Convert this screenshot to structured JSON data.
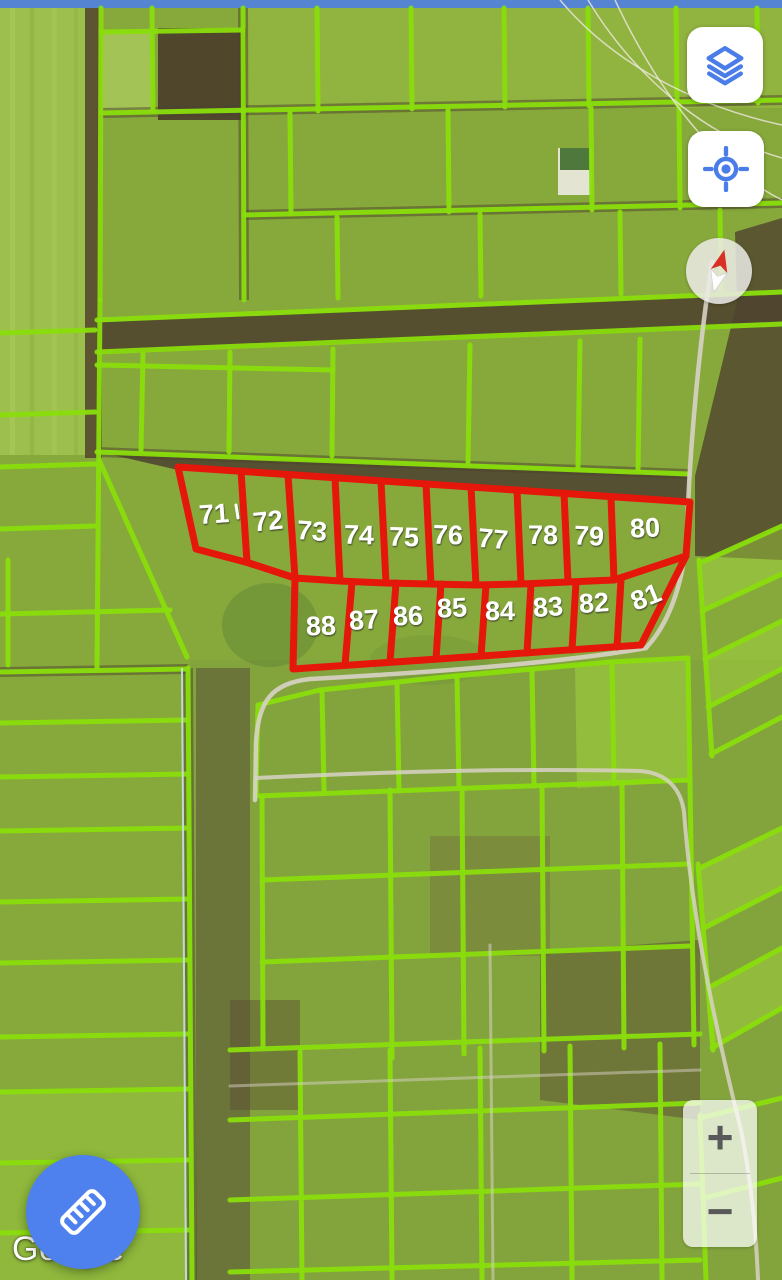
{
  "attribution": {
    "logo_text": "Google"
  },
  "controls": {
    "layers_button": {
      "icon": "layers-icon"
    },
    "my_location_button": {
      "icon": "my-location-icon"
    },
    "compass": {
      "icon": "compass-needle-icon",
      "needle_rotation_deg": 14
    },
    "zoom_in_label": "+",
    "zoom_out_label": "−",
    "measure_button": {
      "icon": "ruler-icon"
    }
  },
  "colors": {
    "control_icon_blue": "#4A7DE8",
    "fab_blue": "#4E80EE",
    "parcel_line_green": "#8ADE0C",
    "selected_parcel_red": "#E5170B",
    "parcel_label_white": "#FFFFFF",
    "field_green": "#87A93C",
    "soil_brown": "#4D4130",
    "top_strip_blue": "#5585D2",
    "road_gray": "#D8D2C6"
  },
  "red_parcels": {
    "row_top_numbers": [
      "71",
      "72",
      "73",
      "74",
      "75",
      "76",
      "77",
      "78",
      "79",
      "80"
    ],
    "row_bottom_numbers": [
      "88",
      "87",
      "86",
      "85",
      "84",
      "83",
      "82",
      "81"
    ],
    "outer": "178,467 690,502 686,556 641,645 293,669 295,578 249,563 196,549",
    "middle_line": "249,563 295,578 340,581 386,583 431,584 476,585 521,584 568,582 614,580 686,556",
    "dividers": [
      [
        241,
        471,
        247,
        562
      ],
      [
        288,
        475,
        295,
        578
      ],
      [
        335,
        478,
        340,
        581
      ],
      [
        381,
        481,
        386,
        583
      ],
      [
        426,
        484,
        431,
        584
      ],
      [
        471,
        487,
        476,
        585
      ],
      [
        517,
        490,
        521,
        584
      ],
      [
        564,
        493,
        568,
        582
      ],
      [
        611,
        497,
        614,
        580
      ],
      [
        352,
        582,
        345,
        665
      ],
      [
        396,
        583,
        390,
        662
      ],
      [
        441,
        584,
        436,
        659
      ],
      [
        486,
        585,
        481,
        656
      ],
      [
        531,
        584,
        527,
        653
      ],
      [
        576,
        582,
        572,
        650
      ],
      [
        621,
        580,
        617,
        647
      ]
    ],
    "labels": [
      {
        "n": "71",
        "x": 214,
        "y": 514,
        "r": -4
      },
      {
        "n": "72",
        "x": 268,
        "y": 521,
        "r": -6
      },
      {
        "n": "73",
        "x": 312,
        "y": 531,
        "r": 4
      },
      {
        "n": "74",
        "x": 359,
        "y": 535,
        "r": 2
      },
      {
        "n": "75",
        "x": 404,
        "y": 537,
        "r": 2
      },
      {
        "n": "76",
        "x": 448,
        "y": 535,
        "r": 2
      },
      {
        "n": "77",
        "x": 493,
        "y": 539,
        "r": 5
      },
      {
        "n": "78",
        "x": 543,
        "y": 535,
        "r": 0
      },
      {
        "n": "79",
        "x": 589,
        "y": 536,
        "r": 3
      },
      {
        "n": "80",
        "x": 645,
        "y": 528,
        "r": -3
      },
      {
        "n": "81",
        "x": 646,
        "y": 597,
        "r": -22
      },
      {
        "n": "82",
        "x": 594,
        "y": 603,
        "r": -4
      },
      {
        "n": "83",
        "x": 548,
        "y": 607,
        "r": -4
      },
      {
        "n": "84",
        "x": 500,
        "y": 611,
        "r": 0
      },
      {
        "n": "85",
        "x": 452,
        "y": 608,
        "r": -3
      },
      {
        "n": "86",
        "x": 408,
        "y": 616,
        "r": -2
      },
      {
        "n": "87",
        "x": 364,
        "y": 620,
        "r": -4
      },
      {
        "n": "88",
        "x": 321,
        "y": 626,
        "r": -2
      }
    ],
    "tick_mark": [
      236,
      505,
      238,
      518
    ]
  },
  "map_geometry": {
    "patches": [
      {
        "r": [
          0,
          8,
          97,
          447
        ],
        "f": "#9CBF4D",
        "o": 1
      },
      {
        "r": [
          10,
          8,
          5,
          447
        ],
        "f": "#AECD61",
        "o": 0.5
      },
      {
        "r": [
          30,
          8,
          4,
          447
        ],
        "f": "#8FB23F",
        "o": 0.6
      },
      {
        "r": [
          52,
          8,
          5,
          447
        ],
        "f": "#AECD61",
        "o": 0.4
      },
      {
        "r": [
          74,
          8,
          4,
          447
        ],
        "f": "#93B542",
        "o": 0.6
      },
      {
        "r": [
          85,
          8,
          17,
          450
        ],
        "f": "#57492F",
        "o": 0.9
      },
      {
        "r": [
          244,
          8,
          538,
          100
        ],
        "f": "#97BA41",
        "o": 0.6
      },
      {
        "r": [
          158,
          28,
          88,
          92
        ],
        "f": "#4A3E2B",
        "o": 0.93
      },
      {
        "p": "97,322 782,294 782,326 97,354",
        "f": "#50422E",
        "o": 0.88
      },
      {
        "p": "100,452 688,476 688,504 178,470",
        "f": "#4E4130",
        "o": 0.85
      },
      {
        "p": "735,232 782,218 782,560 695,556 695,476 737,302",
        "f": "#4F422E",
        "o": 0.8
      },
      {
        "r": [
          196,
          668,
          54,
          612
        ],
        "f": "#554734",
        "o": 0.78
      },
      {
        "r": [
          190,
          660,
          592,
          620
        ],
        "f": "#7E9D3F",
        "o": 0.38
      },
      {
        "p": "540,952 700,940 700,1120 540,1100",
        "f": "#5A4A33",
        "o": 0.5
      },
      {
        "r": [
          230,
          1000,
          70,
          110
        ],
        "f": "#5A4A33",
        "o": 0.45
      },
      {
        "r": [
          430,
          836,
          120,
          120
        ],
        "f": "#6B5A40",
        "o": 0.3
      },
      {
        "p": "575,665 688,658 690,782 577,788",
        "f": "#A4D63E",
        "o": 0.5
      },
      {
        "p": "700,563 782,526 782,574 702,611",
        "f": "#A4D63E",
        "o": 0.45
      },
      {
        "p": "705,659 782,621 782,669 708,707",
        "f": "#A4D63E",
        "o": 0.45
      },
      {
        "p": "700,868 782,828 782,888 704,928",
        "f": "#A4D63E",
        "o": 0.45
      },
      {
        "p": "708,988 782,948 782,1008 712,1048",
        "f": "#A4D63E",
        "o": 0.45
      },
      {
        "r": [
          0,
          1090,
          188,
          190
        ],
        "f": "#9CCF3C",
        "o": 0.4
      },
      {
        "r": [
          101,
          30,
          52,
          82
        ],
        "f": "#B9D96B",
        "o": 0.55
      },
      {
        "e": [
          270,
          625,
          48,
          42
        ],
        "f": "#5D8032",
        "o": 0.45
      },
      {
        "e": [
          430,
          660,
          60,
          25
        ],
        "f": "#6A8F36",
        "o": 0.3
      },
      {
        "r": [
          558,
          148,
          34,
          47
        ],
        "f": "#E9E7DB",
        "o": 0.95
      },
      {
        "r": [
          560,
          148,
          30,
          22
        ],
        "f": "#3E6B2B",
        "o": 0.9
      },
      {
        "r": [
          0,
          0,
          782,
          8
        ],
        "f": "#5585D2",
        "o": 1
      }
    ],
    "dark_underlines": [
      [
        101,
        113,
        782,
        100
      ],
      [
        244,
        215,
        782,
        203
      ],
      [
        243,
        8,
        244,
        300
      ],
      [
        97,
        452,
        688,
        474
      ],
      [
        188,
        668,
        192,
        1280
      ],
      [
        0,
        672,
        188,
        669
      ]
    ],
    "green_segments": [
      [
        101,
        8,
        100,
        300
      ],
      [
        100,
        300,
        97,
        668
      ],
      [
        101,
        32,
        243,
        30
      ],
      [
        152,
        8,
        153,
        111
      ],
      [
        243,
        8,
        244,
        300
      ],
      [
        101,
        113,
        782,
        100
      ],
      [
        317,
        8,
        318,
        111
      ],
      [
        411,
        8,
        412,
        109
      ],
      [
        504,
        8,
        505,
        107
      ],
      [
        588,
        8,
        589,
        106
      ],
      [
        676,
        8,
        677,
        104
      ],
      [
        757,
        8,
        758,
        103
      ],
      [
        244,
        215,
        782,
        203
      ],
      [
        290,
        113,
        291,
        214
      ],
      [
        448,
        110,
        449,
        212
      ],
      [
        591,
        108,
        592,
        210
      ],
      [
        679,
        106,
        680,
        208
      ],
      [
        337,
        217,
        338,
        298
      ],
      [
        480,
        214,
        481,
        296
      ],
      [
        620,
        212,
        621,
        294
      ],
      [
        720,
        210,
        721,
        292
      ],
      [
        97,
        320,
        782,
        292
      ],
      [
        97,
        352,
        782,
        324
      ],
      [
        143,
        354,
        141,
        450
      ],
      [
        230,
        352,
        229,
        452
      ],
      [
        333,
        349,
        332,
        456
      ],
      [
        97,
        365,
        333,
        370
      ],
      [
        470,
        345,
        468,
        462
      ],
      [
        580,
        341,
        578,
        468
      ],
      [
        640,
        339,
        638,
        470
      ],
      [
        97,
        452,
        688,
        474
      ],
      [
        100,
        462,
        187,
        657
      ],
      [
        0,
        333,
        95,
        330
      ],
      [
        0,
        415,
        95,
        412
      ],
      [
        0,
        467,
        95,
        464
      ],
      [
        0,
        529,
        95,
        526
      ],
      [
        0,
        614,
        170,
        610
      ],
      [
        0,
        672,
        188,
        669
      ],
      [
        0,
        723,
        188,
        720
      ],
      [
        0,
        777,
        188,
        774
      ],
      [
        0,
        831,
        188,
        828
      ],
      [
        0,
        902,
        188,
        899
      ],
      [
        0,
        963,
        188,
        960
      ],
      [
        0,
        1037,
        188,
        1034
      ],
      [
        0,
        1092,
        188,
        1089
      ],
      [
        0,
        1163,
        188,
        1160
      ],
      [
        0,
        1233,
        188,
        1230
      ],
      [
        188,
        668,
        192,
        1280
      ],
      [
        8,
        560,
        8,
        665
      ],
      [
        258,
        705,
        320,
        690
      ],
      [
        320,
        690,
        455,
        676
      ],
      [
        455,
        676,
        610,
        662
      ],
      [
        610,
        662,
        688,
        658
      ],
      [
        322,
        690,
        324,
        791
      ],
      [
        397,
        682,
        399,
        790
      ],
      [
        457,
        676,
        459,
        788
      ],
      [
        532,
        670,
        534,
        786
      ],
      [
        612,
        662,
        614,
        784
      ],
      [
        688,
        658,
        690,
        782
      ],
      [
        256,
        796,
        690,
        780
      ],
      [
        258,
        705,
        256,
        796
      ],
      [
        262,
        796,
        263,
        1048
      ],
      [
        390,
        790,
        392,
        1058
      ],
      [
        462,
        788,
        464,
        1054
      ],
      [
        542,
        786,
        544,
        1051
      ],
      [
        622,
        783,
        624,
        1048
      ],
      [
        690,
        782,
        694,
        1045
      ],
      [
        262,
        880,
        690,
        864
      ],
      [
        262,
        962,
        690,
        946
      ],
      [
        230,
        1050,
        700,
        1034
      ],
      [
        230,
        1120,
        700,
        1103
      ],
      [
        230,
        1200,
        700,
        1184
      ],
      [
        230,
        1272,
        700,
        1260
      ],
      [
        300,
        1052,
        302,
        1280
      ],
      [
        390,
        1050,
        392,
        1280
      ],
      [
        480,
        1048,
        482,
        1280
      ],
      [
        570,
        1046,
        572,
        1280
      ],
      [
        660,
        1044,
        662,
        1280
      ],
      [
        700,
        563,
        782,
        526
      ],
      [
        702,
        611,
        782,
        574
      ],
      [
        705,
        659,
        782,
        621
      ],
      [
        708,
        707,
        782,
        669
      ],
      [
        711,
        754,
        782,
        717
      ],
      [
        699,
        560,
        712,
        756
      ],
      [
        700,
        868,
        782,
        828
      ],
      [
        704,
        928,
        782,
        888
      ],
      [
        708,
        988,
        782,
        948
      ],
      [
        712,
        1048,
        782,
        1008
      ],
      [
        698,
        864,
        713,
        1050
      ],
      [
        700,
        1118,
        782,
        1098
      ],
      [
        704,
        1198,
        782,
        1178
      ],
      [
        700,
        1115,
        706,
        1280
      ]
    ],
    "roads": [
      {
        "d": "M712,262 C700,340 690,440 687,530 C685,575 672,620 646,648 C560,663 420,673 310,679 C272,683 258,701 256,743 L255,800",
        "w": 4.5,
        "o": 0.9
      },
      {
        "d": "M256,778 C380,772 520,768 640,771 C668,773 681,790 684,812 C692,920 716,1030 741,1130 C751,1180 756,1230 758,1280",
        "w": 4,
        "o": 0.85
      },
      {
        "d": "M490,945 L493,1280",
        "w": 3,
        "o": 0.55
      },
      {
        "d": "M230,1086 L700,1070",
        "w": 3,
        "o": 0.5
      }
    ],
    "powerlines": [
      "M560,0 C610,60 690,105 782,125",
      "M588,0 C630,70 700,135 782,158",
      "M615,0 C655,85 712,165 782,200"
    ],
    "thin_blue_line": "M182,668 L186,1280"
  }
}
